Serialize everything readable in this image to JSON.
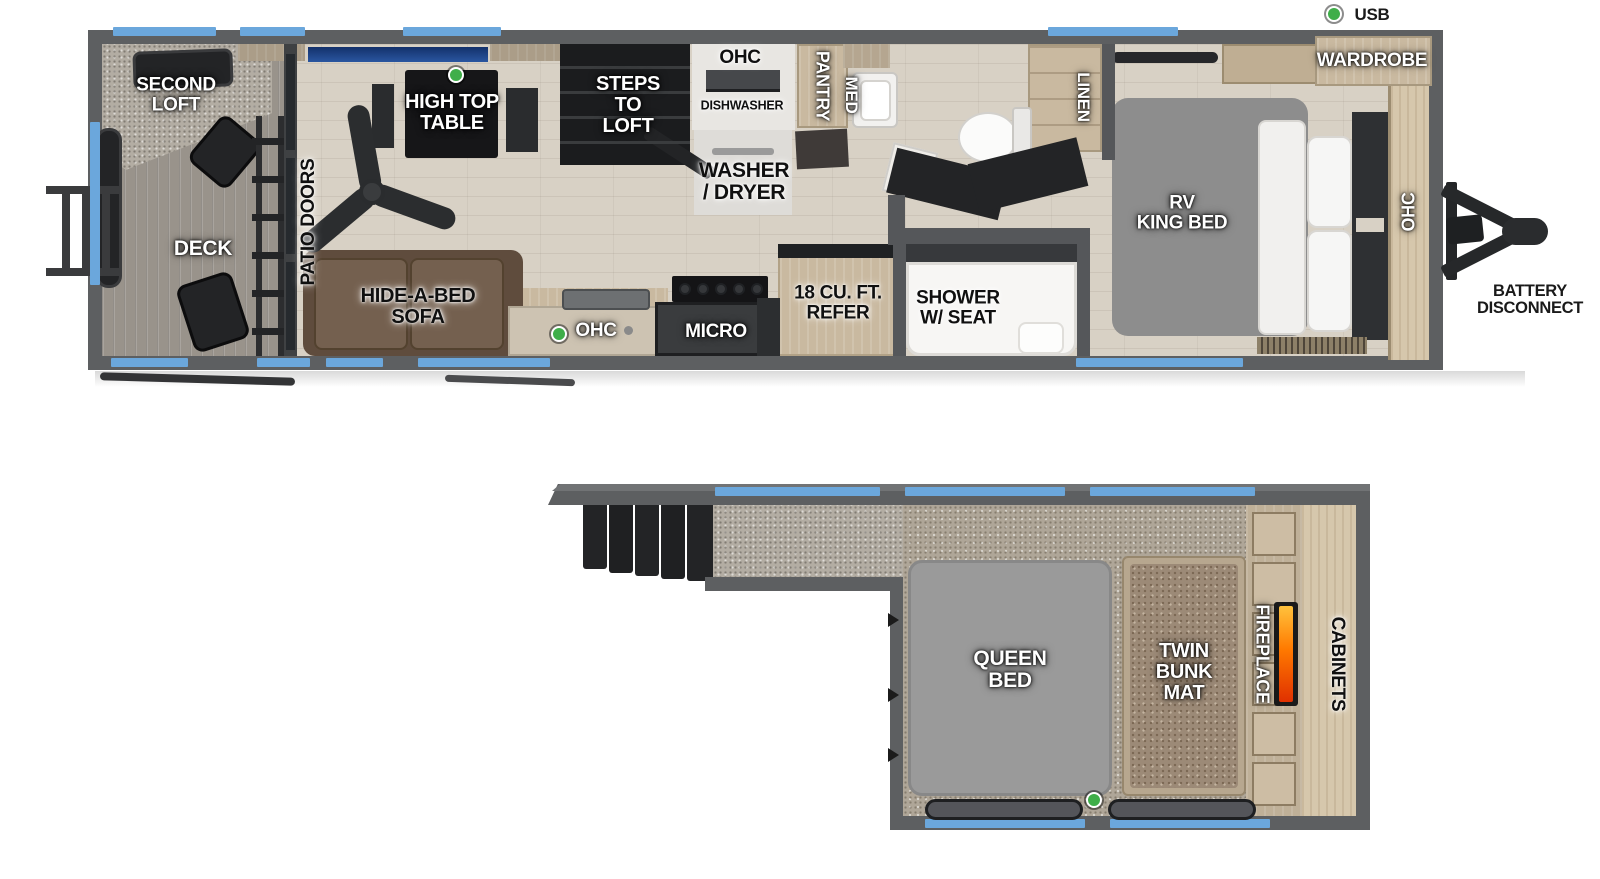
{
  "legend": {
    "usb": "USB"
  },
  "colors": {
    "wall": "#5d5f61",
    "interior_wall": "#55575a",
    "window_blue": "#6ba7dc",
    "floor_wood": "#d8d1c5",
    "carpet_gray": "#b3ada3",
    "loft_carpet": "#afa698",
    "deck_wood": "#99938b",
    "accent_green": "#3fae49",
    "dark_furniture": "#232426",
    "cabinet_tan": "#c9b9a0",
    "sofa_brown": "#6e5847",
    "mattress_gray": "#8d8d8d",
    "bunk_brown": "#9c8a77",
    "flame_orange": "#ff7a00",
    "pillow_white": "#f5f5f4"
  },
  "main": {
    "labels": {
      "second_loft": "SECOND\nLOFT",
      "deck": "DECK",
      "patio_doors": "PATIO DOORS",
      "high_top_table": "HIGH TOP\nTABLE",
      "steps_to_loft": "STEPS\nTO\nLOFT",
      "ohc_dinette": "OHC",
      "dishwasher": "DISHWASHER",
      "washer_dryer": "WASHER\n/ DRYER",
      "pantry": "PANTRY",
      "med": "MED",
      "linen": "LINEN",
      "hide_a_bed_sofa": "HIDE-A-BED\nSOFA",
      "ohc_kitchen": "OHC",
      "micro": "MICRO",
      "refer": "18 CU. FT.\nREFER",
      "shower": "SHOWER\nW/ SEAT",
      "rv_king_bed": "RV\nKING BED",
      "wardrobe": "WARDROBE",
      "ohc_bedroom": "OHC",
      "battery_disconnect": "BATTERY\nDISCONNECT"
    }
  },
  "loft": {
    "labels": {
      "queen_bed": "QUEEN\nBED",
      "twin_bunk_mat": "TWIN\nBUNK\nMAT",
      "fireplace": "FIREPLACE",
      "cabinets": "CABINETS"
    }
  }
}
